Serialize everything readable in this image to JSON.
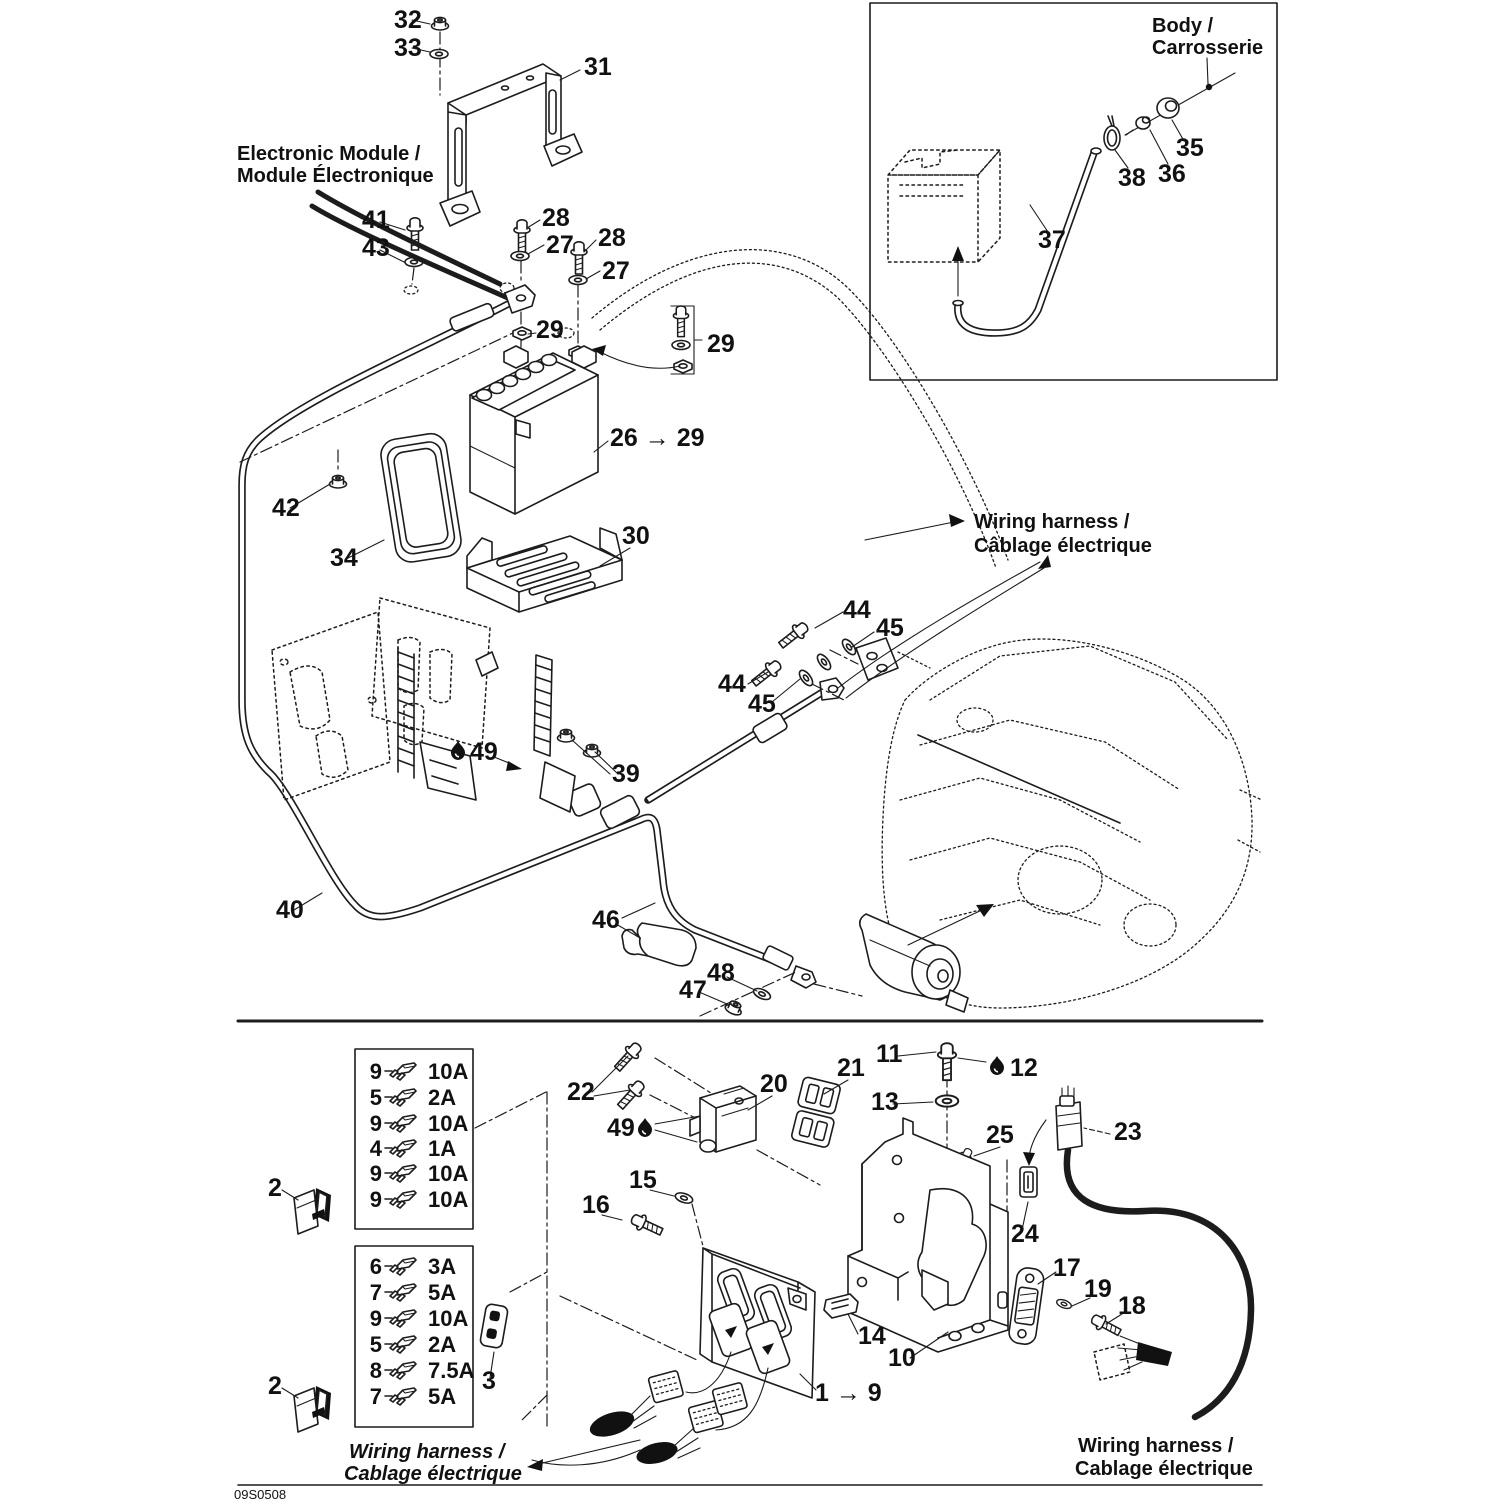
{
  "page": {
    "background": "#ffffff",
    "line_color": "#1c1c1c",
    "doc_code": "09S0508"
  },
  "section_labels": {
    "electronic_module": {
      "line1": "Electronic Module /",
      "line2": "Module Électronique"
    },
    "body": {
      "line1": "Body /",
      "line2": "Carrosserie"
    },
    "wiring_harness_mid": {
      "line1": "Wiring harness /",
      "line2": "Câblage électrique"
    },
    "wiring_harness_bottom_left": {
      "line1": "Wiring harness /",
      "line2": "Cablage électrique"
    },
    "wiring_harness_bottom_right": {
      "line1": "Wiring harness /",
      "line2": "Cablage électrique"
    }
  },
  "callouts": {
    "c1_9": "1 → 9",
    "c2": "2",
    "c3": "3",
    "c10": "10",
    "c11": "11",
    "c12": "12",
    "c13": "13",
    "c14": "14",
    "c15": "15",
    "c16": "16",
    "c17": "17",
    "c18": "18",
    "c19": "19",
    "c20": "20",
    "c21": "21",
    "c22": "22",
    "c23": "23",
    "c24": "24",
    "c25": "25",
    "c26_29": "26 → 29",
    "c27": "27",
    "c28": "28",
    "c29": "29",
    "c30": "30",
    "c31": "31",
    "c32": "32",
    "c33": "33",
    "c34": "34",
    "c35": "35",
    "c36": "36",
    "c37": "37",
    "c38": "38",
    "c39": "39",
    "c40": "40",
    "c41": "41",
    "c42": "42",
    "c43": "43",
    "c44": "44",
    "c45": "45",
    "c46": "46",
    "c47": "47",
    "c48": "48",
    "c49": "49"
  },
  "fuse_box_top": {
    "rows": [
      {
        "qty": "9",
        "amp": "10A"
      },
      {
        "qty": "5",
        "amp": "2A"
      },
      {
        "qty": "9",
        "amp": "10A"
      },
      {
        "qty": "4",
        "amp": "1A"
      },
      {
        "qty": "9",
        "amp": "10A"
      },
      {
        "qty": "9",
        "amp": "10A"
      }
    ]
  },
  "fuse_box_bottom": {
    "rows": [
      {
        "qty": "6",
        "amp": "3A"
      },
      {
        "qty": "7",
        "amp": "5A"
      },
      {
        "qty": "9",
        "amp": "10A"
      },
      {
        "qty": "5",
        "amp": "2A"
      },
      {
        "qty": "8",
        "amp": "7.5A"
      },
      {
        "qty": "7",
        "amp": "5A"
      }
    ]
  }
}
